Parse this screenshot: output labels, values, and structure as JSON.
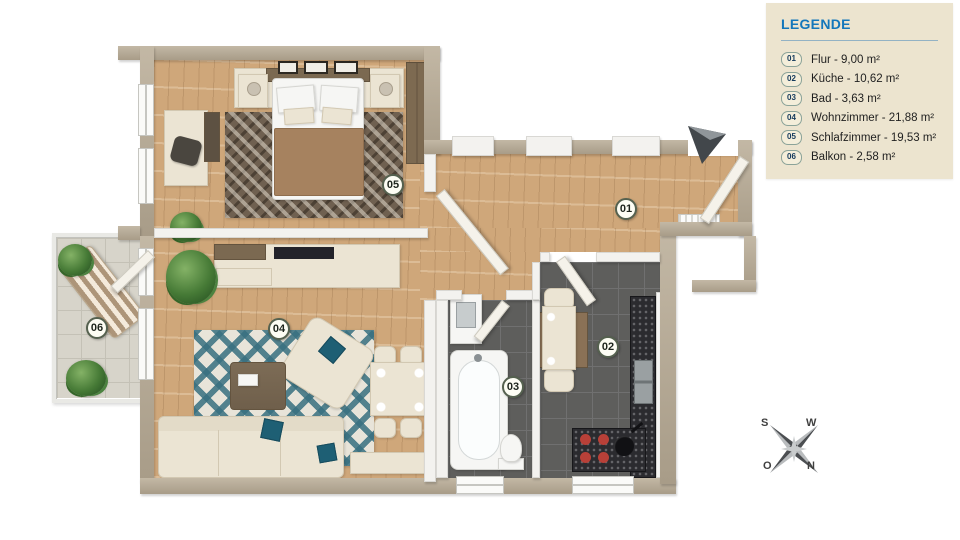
{
  "legend": {
    "title": "LEGENDE",
    "items": [
      {
        "id": "01",
        "label": "Flur - 9,00 m²"
      },
      {
        "id": "02",
        "label": "Küche - 10,62 m²"
      },
      {
        "id": "03",
        "label": "Bad - 3,63 m²"
      },
      {
        "id": "04",
        "label": "Wohnzimmer - 21,88 m²"
      },
      {
        "id": "05",
        "label": "Schlafzimmer - 19,53 m²"
      },
      {
        "id": "06",
        "label": "Balkon - 2,58 m²"
      }
    ]
  },
  "rooms": [
    {
      "number": "01",
      "name": "Flur",
      "area_m2": "9,00"
    },
    {
      "number": "02",
      "name": "Küche",
      "area_m2": "10,62"
    },
    {
      "number": "03",
      "name": "Bad",
      "area_m2": "3,63"
    },
    {
      "number": "04",
      "name": "Wohnzimmer",
      "area_m2": "21,88"
    },
    {
      "number": "05",
      "name": "Schlafzimmer",
      "area_m2": "19,53"
    },
    {
      "number": "06",
      "name": "Balkon",
      "area_m2": "2,58"
    }
  ],
  "compass": {
    "top_left": "S",
    "top_right": "W",
    "bottom_left": "O",
    "bottom_right": "N"
  },
  "colors": {
    "legend_bg": "#ece4cf",
    "legend_title_blue": "#1477bb",
    "wall_tan": "#b6aa97",
    "wood_floor": "#cfa77a",
    "tile_dark_gray": "#5e5e5c",
    "balcony_tile": "#d7d4ca",
    "accent_teal": "#1e5f74",
    "blanket_brown": "#a6825f",
    "burner_red": "#b84038"
  }
}
